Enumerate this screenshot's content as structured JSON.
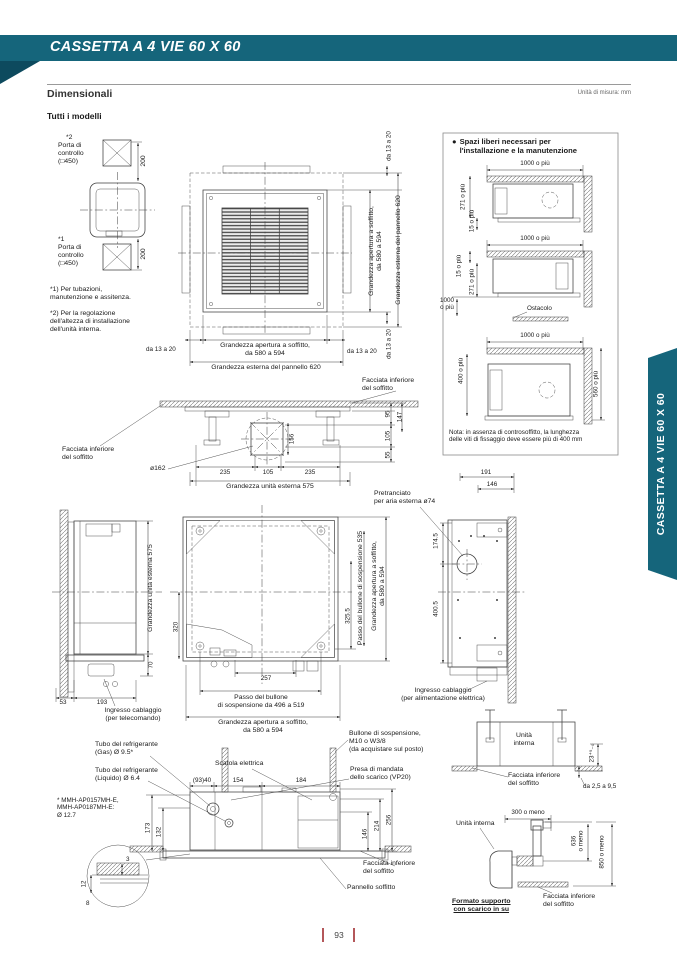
{
  "header": {
    "title": "CASSETTA A 4 VIE 60 X 60",
    "section": "Dimensionali",
    "unit_note": "Unità di misura: mm",
    "subsection": "Tutti i modelli"
  },
  "sidebar": {
    "tab_label": "CASSETTA A 4 VIE 60 X 60"
  },
  "footer": {
    "page_number": "93"
  },
  "colors": {
    "teal": "#15657b",
    "teal_dark": "#0d4a5e",
    "accent_red": "#b4575a"
  },
  "common": {
    "da_13_a_20": "da 13 a 20",
    "facciata_inferiore": "Facciata inferiore\ndel soffitto",
    "apertura_2l": "Grandezza apertura a soffitto,\nda 580 a 594",
    "pannello_620": "Grandezza esterna del pannello 620",
    "unita_esterna_575": "Grandezza unità esterna 575",
    "d1000": "1000 o più",
    "unita_interna": "Unità interna"
  },
  "ports": {
    "star2": "*2",
    "porta_controllo": "Porta di\ncontrollo\n(□450)",
    "d200": "200",
    "star1": "*1",
    "note1": "*1) Per tubazioni,\nmanutenzione e assitenza.",
    "note2": "*2) Per la regolazione\ndell'altezza di installazione\ndell'unità interna."
  },
  "clearance": {
    "bullet": "●",
    "title": "Spazi liberi necessari per\nl'installazione e la manutenzione",
    "d271": "271 o più",
    "d15": "15 o più",
    "d1000_2l": "1000\no più",
    "ostacolo": "Ostacolo",
    "d400": "400 o più",
    "d560": "560 o più",
    "nota": "Nota: in assenza di controsoffitto, la lunghezza\ndelle viti di fissaggio deve essere più di 400 mm"
  },
  "section_view": {
    "d95": "95",
    "d147": "147",
    "d105": "105",
    "d55": "55",
    "d156": "156",
    "dia162": "ø162",
    "d235a": "235",
    "d105b": "105",
    "d235b": "235"
  },
  "side_left": {
    "d70": "70",
    "d53": "53",
    "d193": "193",
    "ingresso_telecomando": "Ingresso cablaggio\n(per telecomando)"
  },
  "plan_bottom": {
    "d320": "320",
    "d257": "257",
    "d325_5": "325.5",
    "passo_535": "Passo del bullone di sospensione 535",
    "passo_496_519": "Passo del bullone\ndi sospensione da 496 a 519",
    "pretranciato": "Pretranciato\nper aria esterna ø74"
  },
  "side_right": {
    "d191": "191",
    "d146": "146",
    "d174_5": "174.5",
    "d400_5": "400.5",
    "ingresso_alimentazione": "Ingresso cablaggio\n(per alimentazione elettrica)"
  },
  "front_view": {
    "tubo_gas": "Tubo del refrigerante\n(Gas) Ø 9.5*",
    "tubo_liquido": "Tubo del refrigerante\n(Liquido) Ø 6.4",
    "nota_modelli": "* MMH-AP0157MH-E,\nMMH-AP0187MH-E:\nØ 12.7",
    "scatola_elettrica": "Scatola elettrica",
    "bullone": "Bullone di sospensione,\nM10 o W3/8\n(da acquistare sul posto)",
    "presa_mandata": "Presa di mandata\ndello scarico (VP20)",
    "d93_40": "(93)40",
    "d154": "154",
    "d184": "184",
    "d173": "173",
    "d132": "132",
    "d146": "146",
    "d214": "214",
    "d256": "256",
    "d3": "3",
    "d12": "12",
    "d8": "8",
    "pannello_soffitto": "Pannello soffitto"
  },
  "support": {
    "unita_interna_2l": "Unità\ninterna",
    "d23": "23⁺⁵₋₀",
    "da_2_5_a_9_5": "da 2,5 a 9,5",
    "d300": "300 o meno",
    "d636_2l": "636\no meno",
    "d850": "850 o meno",
    "formato": "Formato supporto\ncon scarico in su"
  }
}
